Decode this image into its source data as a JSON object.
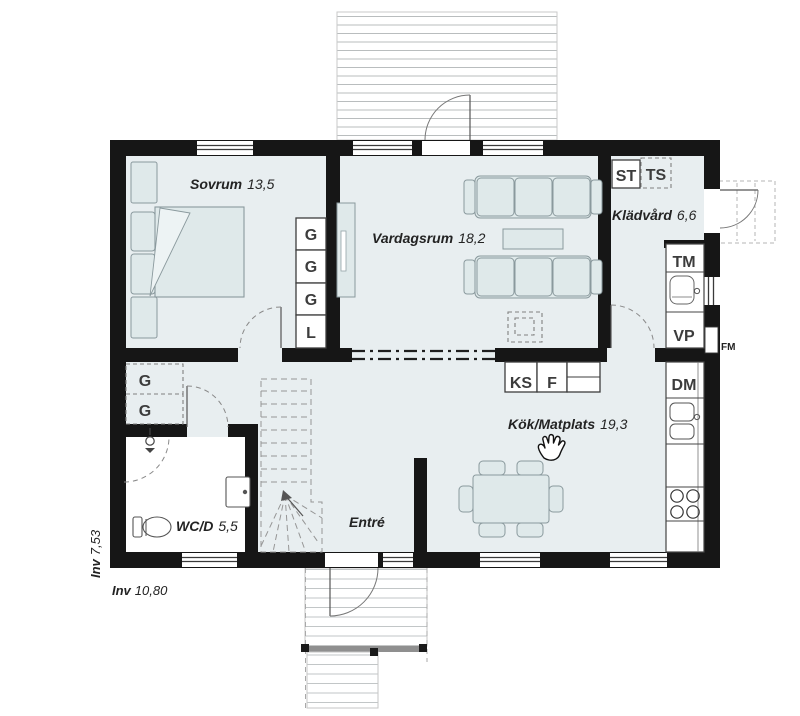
{
  "rooms": {
    "sovrum": {
      "name": "Sovrum",
      "area": "13,5"
    },
    "vardagsrum": {
      "name": "Vardagsrum",
      "area": "18,2"
    },
    "kladvard": {
      "name": "Klädvård",
      "area": "6,6"
    },
    "kok_matplats": {
      "name": "Kök/Matplats",
      "area": "19,3"
    },
    "wcd": {
      "name": "WC/D",
      "area": "5,5"
    },
    "entre": {
      "name": "Entré"
    }
  },
  "measurements": {
    "inner_width": {
      "prefix": "Inv",
      "value": "10,80"
    },
    "inner_depth": {
      "prefix": "Inv",
      "value": "7,53"
    }
  },
  "labels": {
    "bedroom_closets": [
      "G",
      "G",
      "G",
      "L"
    ],
    "hall_closets": [
      "G",
      "G"
    ],
    "st": "ST",
    "ts": "TS",
    "tm": "TM",
    "vp": "VP",
    "fm": "FM",
    "dm": "DM",
    "ks": "KS",
    "f": "F"
  },
  "colors": {
    "wall": "#161616",
    "floor": "#e8eef0",
    "furniture": "#dfe9ea",
    "deck_line": "#b9bdbe"
  }
}
